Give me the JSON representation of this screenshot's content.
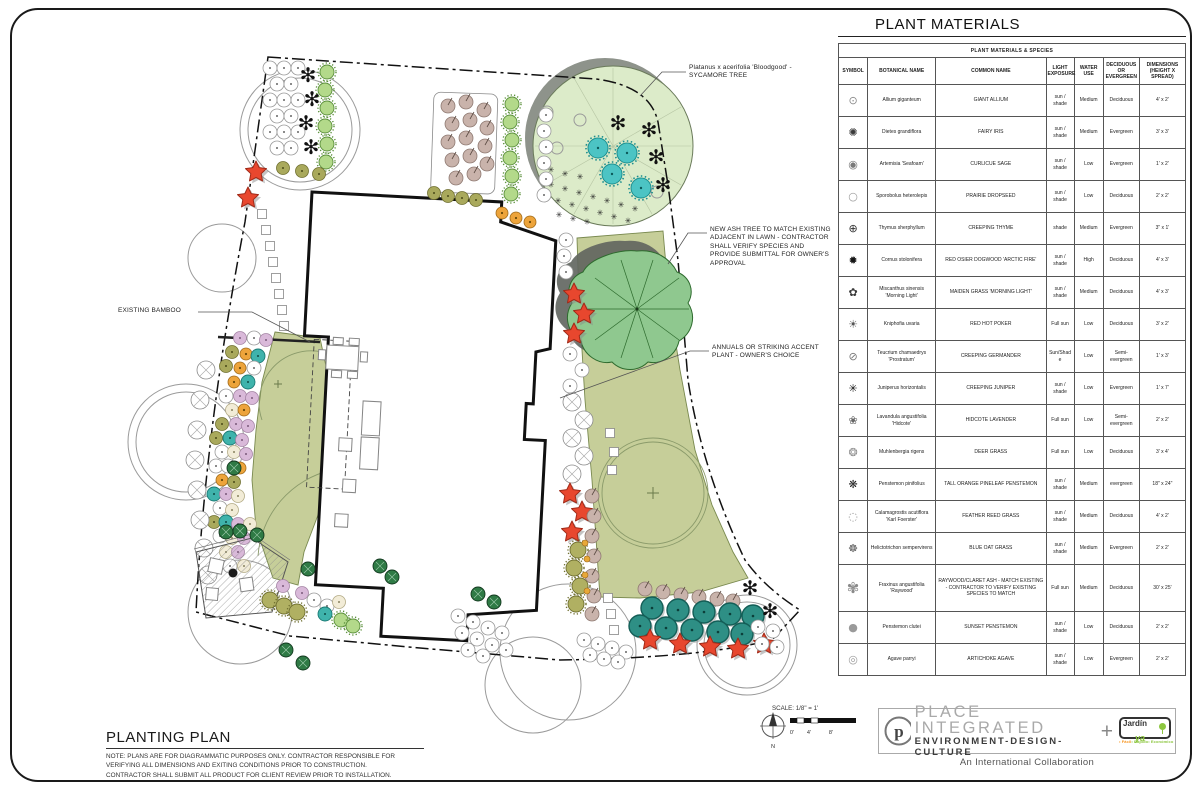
{
  "plan": {
    "annotations": {
      "sycamore": "Platanus x acerifolia 'Bloodgood' - SYCAMORE TREE",
      "ash": "NEW ASH TREE TO MATCH EXISTING ADJACENT IN LAWN - CONTRACTOR SHALL VERIFY SPECIES AND PROVIDE SUBMITTAL FOR OWNER'S APPROVAL",
      "annuals": "ANNUALS OR STRIKING ACCENT PLANT - OWNER'S CHOICE",
      "bamboo": "EXISTING BAMBOO"
    },
    "scale": {
      "label": "SCALE: 1/8\" = 1'",
      "t0": "0'",
      "t4": "4'",
      "t8": "8'",
      "north": "N"
    }
  },
  "title_block": {
    "title": "PLANTING PLAN",
    "note": "NOTE: PLANS ARE FOR DIAGRAMMATIC PURPOSES ONLY. CONTRACTOR RESPONSIBLE FOR VERIFYING ALL DIMENSIONS AND EXITING CONDITIONS PRIOR TO CONSTRUCTION. CONTRACTOR SHALL SUBMIT ALL PRODUCT FOR CLIENT REVIEW PRIOR TO INSTALLATION."
  },
  "plant_table": {
    "title": "PLANT MATERIALS",
    "subtitle": "PLANT MATERIALS & SPECIES",
    "headers": [
      "SYMBOL",
      "BOTANICAL NAME",
      "COMMON NAME",
      "LIGHT EXPOSURE",
      "WATER USE",
      "DECIDUOUS OR EVERGREEN",
      "DIMENSIONS (HEIGHT X SPREAD)"
    ],
    "rows": [
      {
        "symbol": "allium",
        "botanical": "Allium giganteum",
        "common": "GIANT ALLIUM",
        "light": "sun / shade",
        "water": "Medium",
        "type": "Deciduous",
        "dims": "4' x 2'"
      },
      {
        "symbol": "dietes",
        "botanical": "Dietes grandiflora",
        "common": "FAIRY IRIS",
        "light": "sun / shade",
        "water": "Medium",
        "type": "Evergreen",
        "dims": "3' x 3'"
      },
      {
        "symbol": "artemisia",
        "botanical": "Artemisia 'Seafoam'",
        "common": "CURLICUE SAGE",
        "light": "sun / shade",
        "water": "Low",
        "type": "Evergreen",
        "dims": "1' x 2'"
      },
      {
        "symbol": "sporobolus",
        "botanical": "Sporobolus heterolepis",
        "common": "PRAIRIE DROPSEED",
        "light": "sun / shade",
        "water": "Low",
        "type": "Deciduous",
        "dims": "2' x 2'"
      },
      {
        "symbol": "thymus",
        "botanical": "Thymus sherphyllum",
        "common": "CREEPING THYME",
        "light": "shade",
        "water": "Medium",
        "type": "Evergreen",
        "dims": "3\" x 1'"
      },
      {
        "symbol": "cornus",
        "botanical": "Cornus stolonifera",
        "common": "RED OSIER DOGWOOD 'ARCTIC FIRE'",
        "light": "sun / shade",
        "water": "High",
        "type": "Deciduous",
        "dims": "4' x 3'"
      },
      {
        "symbol": "miscanthus",
        "botanical": "Miscanthus sinensis 'Morning Light'",
        "common": "MAIDEN GRASS 'MORNING LIGHT'",
        "light": "sun / shade",
        "water": "Medium",
        "type": "Deciduous",
        "dims": "4' x 3'"
      },
      {
        "symbol": "kniphofia",
        "botanical": "Kniphofia uvaria",
        "common": "RED HOT POKER",
        "light": "Full sun",
        "water": "Low",
        "type": "Deciduous",
        "dims": "3' x 2'"
      },
      {
        "symbol": "teucrium",
        "botanical": "Teucrium chamaedrys 'Prostratum'",
        "common": "CREEPING GERMANDER",
        "light": "Sun/Shade",
        "water": "Low",
        "type": "Semi-evergreen",
        "dims": "1' x 3'"
      },
      {
        "symbol": "juniperus",
        "botanical": "Juniperus horizontalis",
        "common": "CREEPING JUNIPER",
        "light": "sun / shade",
        "water": "Low",
        "type": "Evergreen",
        "dims": "1' x 7'"
      },
      {
        "symbol": "lavandula",
        "botanical": "Lavandula angustifolia 'Hidcote'",
        "common": "HIDCOTE LAVENDER",
        "light": "Full sun",
        "water": "Low",
        "type": "Semi-evergreen",
        "dims": "2' x 2'"
      },
      {
        "symbol": "muhlenbergia",
        "botanical": "Muhlenbergia rigens",
        "common": "DEER GRASS",
        "light": "Full sun",
        "water": "Low",
        "type": "Deciduous",
        "dims": "3' x 4'"
      },
      {
        "symbol": "penstemon-pine",
        "botanical": "Penstemon pinifolius",
        "common": "TALL ORANGE PINELEAF PENSTEMON",
        "light": "sun / shade",
        "water": "Medium",
        "type": "evergreen",
        "dims": "18\" x 24\""
      },
      {
        "symbol": "calamagrostis",
        "botanical": "Calamagrostis acutiflora 'Karl Foerster'",
        "common": "FEATHER REED GRASS",
        "light": "sun / shade",
        "water": "Medium",
        "type": "Deciduous",
        "dims": "4' x 2'"
      },
      {
        "symbol": "helictotrichon",
        "botanical": "Helictotrichon sempervirens",
        "common": "BLUE OAT GRASS",
        "light": "sun / shade",
        "water": "Medium",
        "type": "Evergreen",
        "dims": "2' x 2'"
      },
      {
        "symbol": "fraxinus",
        "botanical": "Fraxinus angustifolia 'Raywood'",
        "common": "RAYWOOD/CLARET ASH - MATCH EXISTING - CONTRACTOR TO VERIFY EXISTING SPECIES TO MATCH",
        "light": "Full sun",
        "water": "Medium",
        "type": "Deciduous",
        "dims": "30' x 25'",
        "tall": true
      },
      {
        "symbol": "penstemon-sunset",
        "botanical": "Penstemon clutei",
        "common": "SUNSET PENSTEMON",
        "light": "sun / shade",
        "water": "Low",
        "type": "Deciduous",
        "dims": "2' x 2'"
      },
      {
        "symbol": "agave",
        "botanical": "Agave parryi",
        "common": "ARTICHOKE AGAVE",
        "light": "sun / shade",
        "water": "Low",
        "type": "Evergreen",
        "dims": "2' x 2'"
      }
    ]
  },
  "footer": {
    "brand": "PLACE INTEGRATED",
    "brand_sub": "ENVIRONMENT-DESIGN-CULTURE",
    "plus": "+",
    "jardin_word1": "Jardín",
    "jardin_word2": "ya",
    "tagline": [
      "• Fácil",
      "• Rápido",
      "• Económico"
    ],
    "collab": "An International Collaboration"
  },
  "colors": {
    "lawn": "#c6ce99",
    "ash_canopy": "#8fc88f",
    "sycamore": "#dcebc9",
    "teal_plant": "#2e8f85",
    "cyan_plant": "#4cc4c4",
    "red_flower": "#e8472e",
    "orange_plant": "#eda43b",
    "pink_plant": "#d9b9d9",
    "olive_plant": "#a9a95c",
    "tan_plant": "#c9b3ab",
    "dark_green_tree": "#2f7a45",
    "logo_green": "#8cc63f",
    "logo_orange": "#f7941d"
  }
}
